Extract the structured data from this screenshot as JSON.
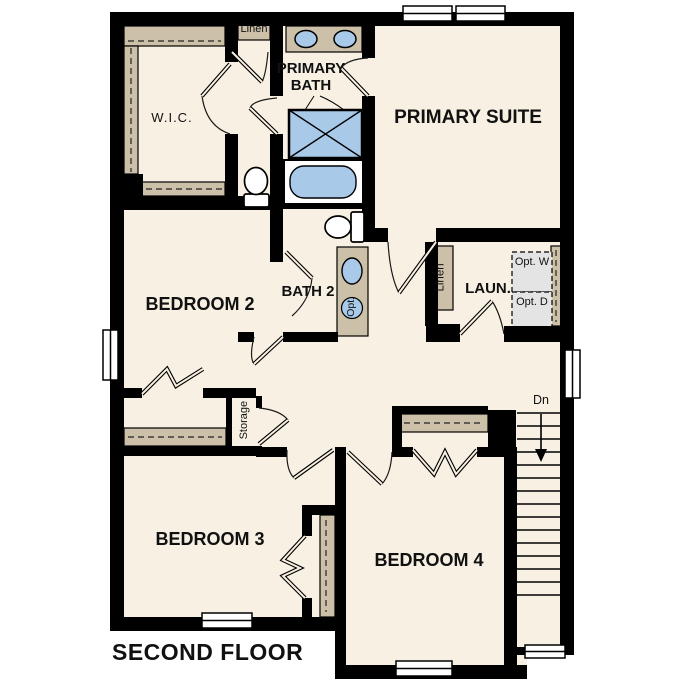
{
  "title": "SECOND FLOOR",
  "rooms": {
    "primary_bath": "PRIMARY BATH",
    "primary_suite": "PRIMARY SUITE",
    "wic": "W.I.C.",
    "bedroom2": "BEDROOM 2",
    "bath2": "BATH 2",
    "laundry": "LAUN.",
    "bedroom3": "BEDROOM 3",
    "bedroom4": "BEDROOM 4"
  },
  "closets": {
    "linen_top": "Linen",
    "linen_laundry": "Linen",
    "storage": "Storage"
  },
  "annotations": {
    "stairs_down": "Dn",
    "optional_sink": "Opt.",
    "optional_washer": "Opt. W",
    "optional_dryer": "Opt. D"
  },
  "colors": {
    "wall": "#000000",
    "floor": "#f8f1e3",
    "casework_tan": "#cdc0a8",
    "fixture_blue": "#a9c9e9",
    "optional_gray": "#e4e4e4"
  }
}
